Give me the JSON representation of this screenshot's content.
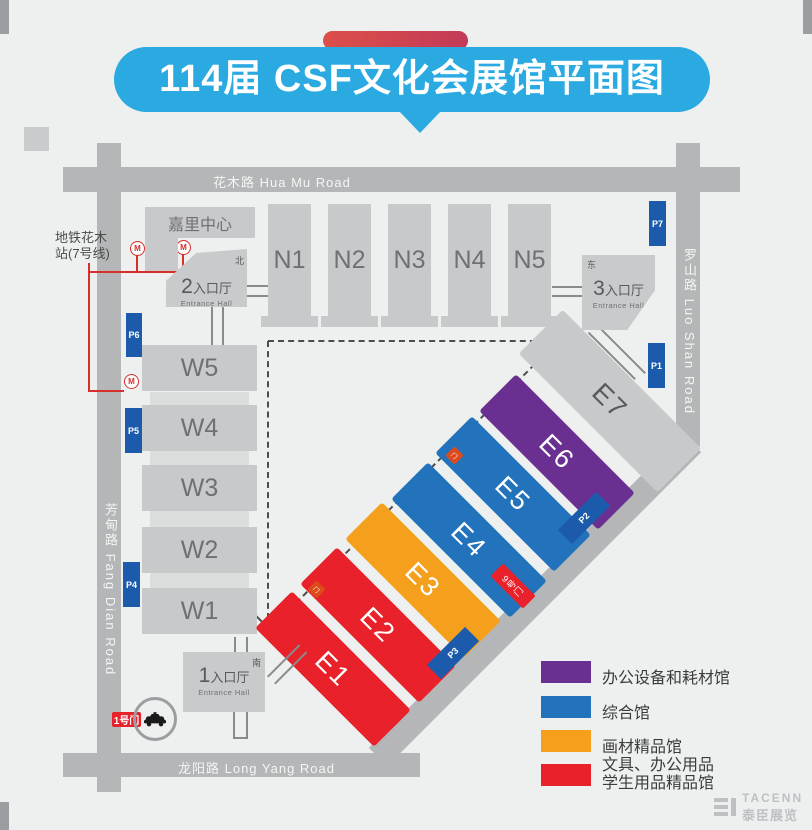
{
  "title": {
    "text": "114届 CSF文化会展馆平面图"
  },
  "roads": {
    "top": "花木路 Hua Mu Road",
    "left": "芳甸路 Fang Dian Road",
    "right": "罗山路 Luo Shan Road",
    "bottom": "龙阳路 Long Yang Road"
  },
  "metro": {
    "line1": "地铁花木",
    "line2": "站(7号线)",
    "icon": "M"
  },
  "kerry_center": "嘉里中心",
  "entrances": [
    {
      "num": "1",
      "hall": "入口厅",
      "en": "Entrance Hall",
      "dir": "南"
    },
    {
      "num": "2",
      "hall": "入口厅",
      "en": "Entrance Hall",
      "dir": "北"
    },
    {
      "num": "3",
      "hall": "入口厅",
      "en": "Entrance Hall",
      "dir": "东"
    }
  ],
  "north_halls": [
    "N1",
    "N2",
    "N3",
    "N4",
    "N5"
  ],
  "west_halls": [
    "W5",
    "W4",
    "W3",
    "W2",
    "W1"
  ],
  "east_halls": [
    {
      "label": "E1",
      "color": "#e8212a"
    },
    {
      "label": "E2",
      "color": "#e8212a"
    },
    {
      "label": "E3",
      "color": "#f5a01d"
    },
    {
      "label": "E4",
      "color": "#2273bb"
    },
    {
      "label": "E5",
      "color": "#2273bb"
    },
    {
      "label": "E6",
      "color": "#6a3091"
    },
    {
      "label": "E7",
      "color": "#c8c9ca"
    }
  ],
  "parking": [
    "P1",
    "P2",
    "P3",
    "P4",
    "P5",
    "P6",
    "P7"
  ],
  "gates": {
    "gate1": "1号门",
    "gate9": "9号门",
    "small_marker": "门"
  },
  "legend": [
    {
      "color": "#6a3091",
      "label": "办公设备和耗材馆"
    },
    {
      "color": "#2273bb",
      "label": "综合馆"
    },
    {
      "color": "#f5a01d",
      "label": "画材精品馆"
    },
    {
      "color": "#e8212a",
      "label": "文具、办公用品",
      "label2": "学生用品精品馆"
    }
  ],
  "watermark": {
    "en": "TACENN",
    "cn": "泰臣展览"
  },
  "colors": {
    "road": "#b5b6b7",
    "hall_gray": "#c8c9ca",
    "title_blue": "#2baae2",
    "parking_blue": "#1c5bab",
    "metro_red": "#d6302c"
  }
}
